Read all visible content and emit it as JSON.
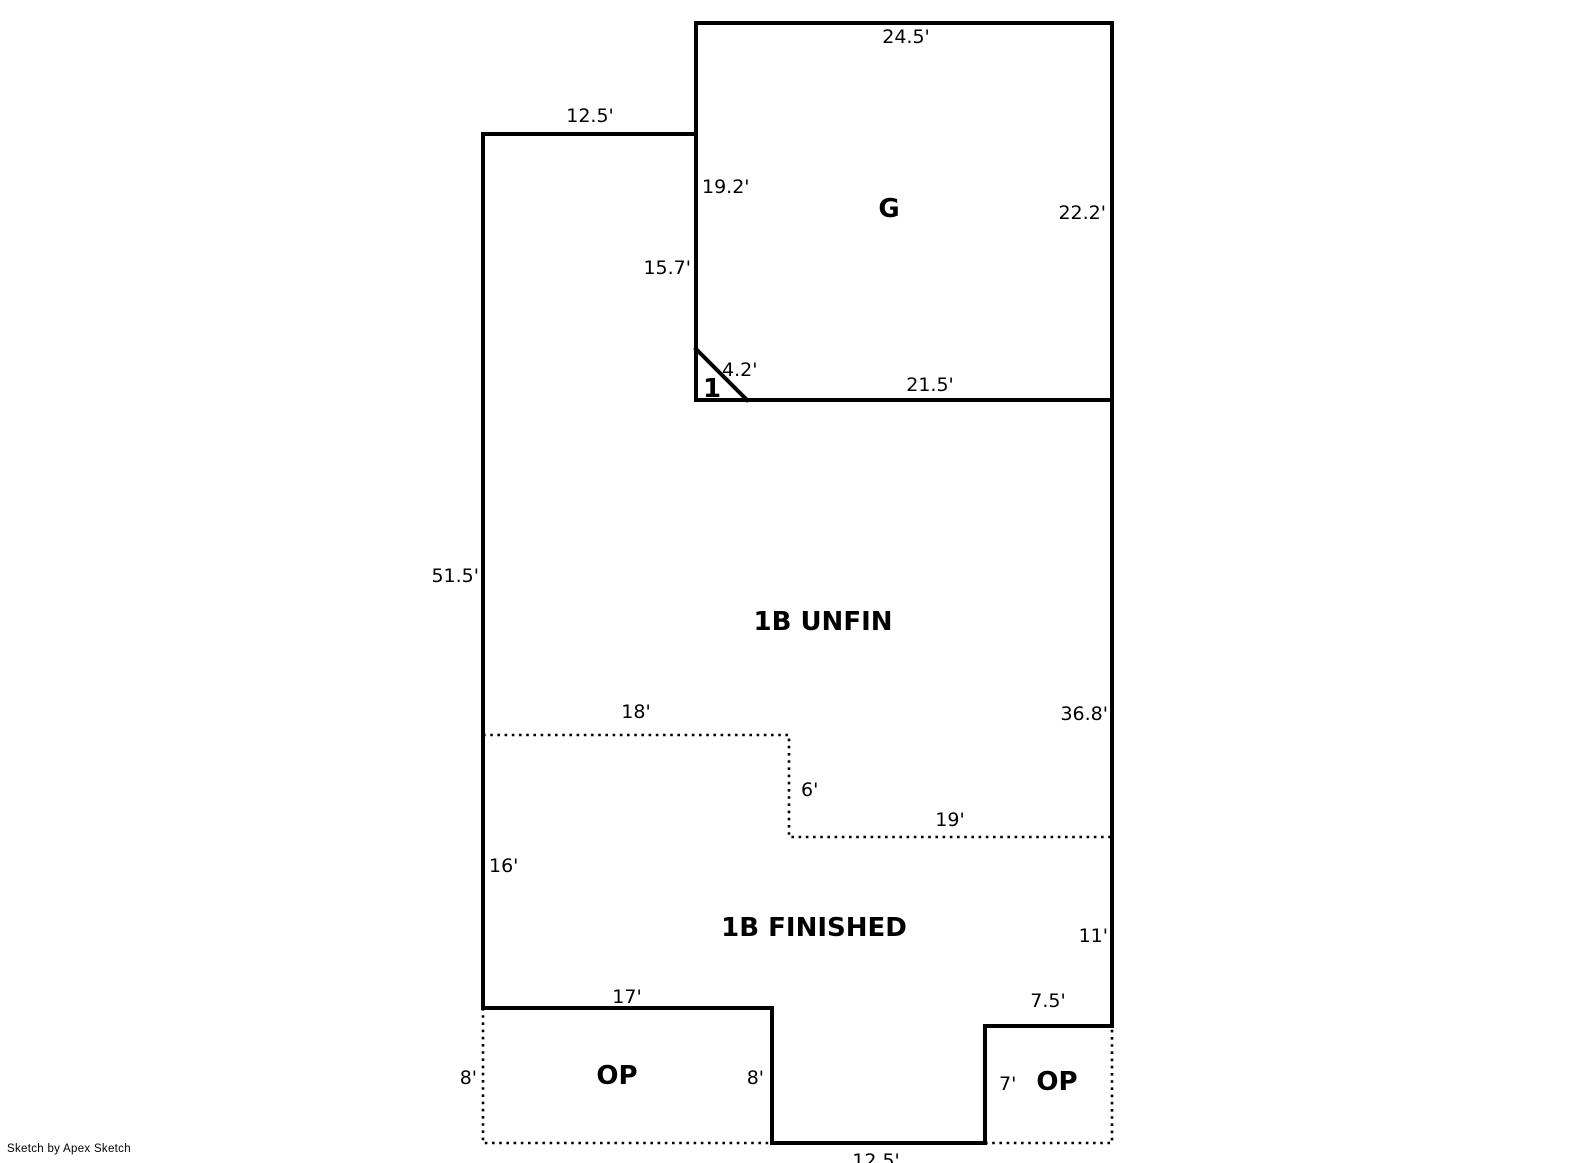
{
  "canvas": {
    "background_color": "#ffffff",
    "line_color": "#000000",
    "text_color": "#000000"
  },
  "footer": {
    "credit": "Sketch by Apex Sketch"
  },
  "areas": [
    {
      "name": "area-label-garage",
      "text": "G",
      "x": 889,
      "y": 208
    },
    {
      "name": "area-label-corner-1",
      "text": "1",
      "x": 712,
      "y": 388
    },
    {
      "name": "area-label-1b-unfin",
      "text": "1B UNFIN",
      "x": 823,
      "y": 621
    },
    {
      "name": "area-label-1b-finished",
      "text": "1B FINISHED",
      "x": 814,
      "y": 927
    },
    {
      "name": "area-label-op-left",
      "text": "OP",
      "x": 617,
      "y": 1075
    },
    {
      "name": "area-label-op-right",
      "text": "OP",
      "x": 1057,
      "y": 1081
    }
  ],
  "dimensions": [
    {
      "name": "dim-top-offset",
      "text": "12.5'",
      "x": 590,
      "y": 115,
      "align": "middle"
    },
    {
      "name": "dim-garage-top",
      "text": "24.5'",
      "x": 906,
      "y": 36,
      "align": "middle"
    },
    {
      "name": "dim-garage-left",
      "text": "19.2'",
      "x": 702,
      "y": 186,
      "align": "start"
    },
    {
      "name": "dim-garage-right",
      "text": "22.2'",
      "x": 1106,
      "y": 212,
      "align": "end"
    },
    {
      "name": "dim-unfin-upper-left",
      "text": "15.7'",
      "x": 691,
      "y": 267,
      "align": "end"
    },
    {
      "name": "dim-corner-diagonal",
      "text": "4.2'",
      "x": 722,
      "y": 369,
      "align": "start"
    },
    {
      "name": "dim-garage-bottom",
      "text": "21.5'",
      "x": 930,
      "y": 384,
      "align": "middle"
    },
    {
      "name": "dim-left-wall",
      "text": "51.5'",
      "x": 479,
      "y": 575,
      "align": "end"
    },
    {
      "name": "dim-divider-top",
      "text": "18'",
      "x": 636,
      "y": 711,
      "align": "middle"
    },
    {
      "name": "dim-right-wall-lower",
      "text": "36.8'",
      "x": 1108,
      "y": 713,
      "align": "end"
    },
    {
      "name": "dim-divider-drop",
      "text": "6'",
      "x": 801,
      "y": 789,
      "align": "start"
    },
    {
      "name": "dim-divider-bottom",
      "text": "19'",
      "x": 950,
      "y": 819,
      "align": "middle"
    },
    {
      "name": "dim-left-wall-16",
      "text": "16'",
      "x": 489,
      "y": 865,
      "align": "start"
    },
    {
      "name": "dim-right-wall-11",
      "text": "11'",
      "x": 1108,
      "y": 935,
      "align": "end"
    },
    {
      "name": "dim-bottom-17",
      "text": "17'",
      "x": 627,
      "y": 996,
      "align": "middle"
    },
    {
      "name": "dim-bottom-7-5",
      "text": "7.5'",
      "x": 1048,
      "y": 1000,
      "align": "middle"
    },
    {
      "name": "dim-op-left-8",
      "text": "8'",
      "x": 477,
      "y": 1077,
      "align": "end"
    },
    {
      "name": "dim-op-left-inner-8",
      "text": "8'",
      "x": 764,
      "y": 1077,
      "align": "end"
    },
    {
      "name": "dim-op-right-7",
      "text": "7'",
      "x": 999,
      "y": 1083,
      "align": "start"
    },
    {
      "name": "dim-bottom-12-5",
      "text": "12.5'",
      "x": 876,
      "y": 1160,
      "align": "middle"
    }
  ],
  "walls": {
    "solid": [
      {
        "name": "outline-main",
        "closed": true,
        "points": [
          [
            483,
            134
          ],
          [
            696,
            134
          ],
          [
            696,
            23
          ],
          [
            1112,
            23
          ],
          [
            1112,
            1026
          ],
          [
            985,
            1026
          ],
          [
            985,
            1143
          ],
          [
            772,
            1143
          ],
          [
            772,
            1008
          ],
          [
            483,
            1008
          ]
        ]
      },
      {
        "name": "wall-garage-interior",
        "closed": false,
        "points": [
          [
            696,
            134
          ],
          [
            696,
            400
          ],
          [
            1112,
            400
          ]
        ]
      },
      {
        "name": "wall-garage-diagonal",
        "closed": false,
        "points": [
          [
            696,
            349
          ],
          [
            747,
            400
          ]
        ]
      }
    ],
    "dotted": [
      {
        "name": "divider-basement-dotted",
        "closed": false,
        "points": [
          [
            483,
            735
          ],
          [
            789,
            735
          ],
          [
            789,
            837
          ],
          [
            1112,
            837
          ]
        ]
      },
      {
        "name": "outline-op-left-dotted",
        "closed": false,
        "points": [
          [
            483,
            1008
          ],
          [
            483,
            1143
          ],
          [
            772,
            1143
          ]
        ]
      },
      {
        "name": "outline-op-right-dotted",
        "closed": false,
        "points": [
          [
            985,
            1143
          ],
          [
            1112,
            1143
          ],
          [
            1112,
            1026
          ]
        ]
      }
    ]
  }
}
